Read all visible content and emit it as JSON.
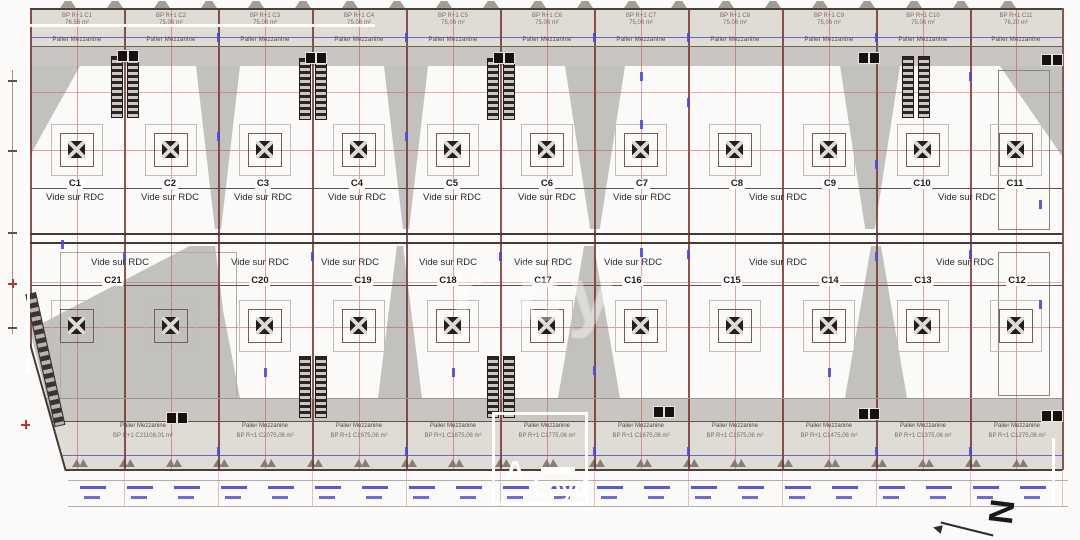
{
  "labels": {
    "vide": "Vide sur RDC",
    "palier": "Palier Mezzanine",
    "north": "N"
  },
  "colors": {
    "grid_red": "#a0392f",
    "dimension_blue": "#4b41c8",
    "fill_gray": "#c9c6c1"
  },
  "upper_units": [
    {
      "id": "C1"
    },
    {
      "id": "C2"
    },
    {
      "id": "C3"
    },
    {
      "id": "C4"
    },
    {
      "id": "C5"
    },
    {
      "id": "C6"
    },
    {
      "id": "C7"
    },
    {
      "id": "C8"
    },
    {
      "id": "C9"
    },
    {
      "id": "C10"
    },
    {
      "id": "C11"
    }
  ],
  "lower_units": [
    {
      "id": "C21"
    },
    {
      "id": "C20"
    },
    {
      "id": "C19"
    },
    {
      "id": "C18"
    },
    {
      "id": "C17"
    },
    {
      "id": "C16"
    },
    {
      "id": "C15"
    },
    {
      "id": "C14"
    },
    {
      "id": "C13"
    },
    {
      "id": "C12"
    }
  ],
  "top_cells": [
    {
      "ref": "BP R+1 C1",
      "area": "76,56 m²"
    },
    {
      "ref": "BP R+1 C2",
      "area": "75,06 m²"
    },
    {
      "ref": "BP R+1 C3",
      "area": "75,06 m²"
    },
    {
      "ref": "BP R+1 C4",
      "area": "75,06 m²"
    },
    {
      "ref": "BP R+1 C5",
      "area": "75,06 m²"
    },
    {
      "ref": "BP R+1 C6",
      "area": "75,06 m²"
    },
    {
      "ref": "BP R+1 C7",
      "area": "75,06 m²"
    },
    {
      "ref": "BP R+1 C8",
      "area": "75,06 m²"
    },
    {
      "ref": "BP R+1 C9",
      "area": "75,06 m²"
    },
    {
      "ref": "BP R+1 C10",
      "area": "75,06 m²"
    },
    {
      "ref": "BP R+1 C11",
      "area": "76,20 m²"
    }
  ],
  "bottom_cells": [
    {
      "ref": "BP R+1 C21",
      "area": "108,01 m²"
    },
    {
      "ref": "BP R+1 C20",
      "area": "75,06 m²"
    },
    {
      "ref": "BP R+1 C19",
      "area": "75,06 m²"
    },
    {
      "ref": "BP R+1 C18",
      "area": "75,06 m²"
    },
    {
      "ref": "BP R+1 C17",
      "area": "75,06 m²"
    },
    {
      "ref": "BP R+1 C16",
      "area": "75,06 m²"
    },
    {
      "ref": "BP R+1 C15",
      "area": "75,06 m²"
    },
    {
      "ref": "BP R+1 C14",
      "area": "75,06 m²"
    },
    {
      "ref": "BP R+1 C13",
      "area": "75,06 m²"
    },
    {
      "ref": "BP R+1 C12",
      "area": "75,06 m²"
    }
  ],
  "watermark": {
    "letter": "A",
    "name": "Loyd",
    "center": "r by"
  }
}
